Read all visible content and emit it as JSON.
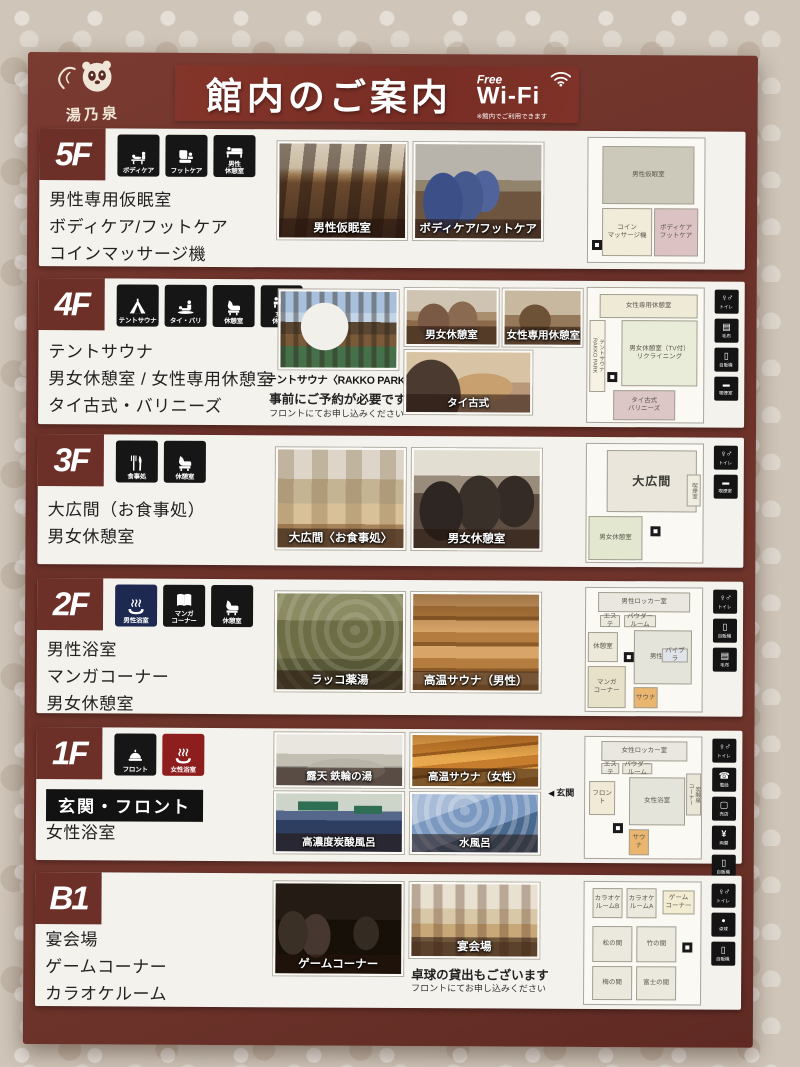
{
  "header": {
    "logo_text": "湯乃泉",
    "title": "館内のご案内",
    "wifi": {
      "free": "Free",
      "name": "Wi-Fi",
      "note": "※館内でご利用できます"
    }
  },
  "floors": [
    {
      "badge": "5F",
      "icons": [
        {
          "label": "ボディケア"
        },
        {
          "label": "フットケア"
        },
        {
          "label": "男性\n休憩室"
        }
      ],
      "facilities": [
        "男性専用仮眠室",
        "ボディケア/フットケア",
        "コインマッサージ機"
      ],
      "photos": [
        {
          "caption": "男性仮眠室"
        },
        {
          "caption": "ボディケア/フットケア"
        }
      ],
      "map": {
        "rooms": [
          "男性仮眠室",
          "コイン\nマッサージ機",
          "ボディケア\nフットケア"
        ],
        "side": []
      }
    },
    {
      "badge": "4F",
      "icons": [
        {
          "label": "テントサウナ"
        },
        {
          "label": "タイ・バリ"
        },
        {
          "label": "休憩室"
        },
        {
          "label": "女性\n休憩室"
        }
      ],
      "facilities": [
        "テントサウナ",
        "男女休憩室 / 女性専用休憩室",
        "タイ古式・バリニーズ"
      ],
      "photos": [
        {
          "caption": "テントサウナ〈RAKKO PARK〉"
        },
        {
          "caption": "男女休憩室"
        },
        {
          "caption": "女性専用休憩室"
        },
        {
          "caption": "タイ古式"
        }
      ],
      "notes": [
        "事前にご予約が必要です",
        "フロントにてお申し込みください"
      ],
      "map": {
        "rooms": [
          "女性専用休憩室",
          "男女休憩室（TV付）\nリクライニング",
          "テントサウナ\nRAKKO PARK",
          "タイ古式\nバリニーズ"
        ],
        "side": [
          "トイレ",
          "毛布",
          "自販機",
          "喫煙室"
        ]
      }
    },
    {
      "badge": "3F",
      "icons": [
        {
          "label": "食事処"
        },
        {
          "label": "休憩室"
        }
      ],
      "facilities": [
        "大広間（お食事処）",
        "男女休憩室"
      ],
      "photos": [
        {
          "caption": "大広間〈お食事処〉"
        },
        {
          "caption": "男女休憩室"
        }
      ],
      "map": {
        "rooms": [
          "大広間",
          "男女休憩室",
          "喫煙室"
        ],
        "side": [
          "トイレ",
          "喫煙室"
        ]
      }
    },
    {
      "badge": "2F",
      "icons": [
        {
          "label": "男性浴室"
        },
        {
          "label": "マンガ\nコーナー"
        },
        {
          "label": "休憩室"
        }
      ],
      "facilities": [
        "男性浴室",
        "マンガコーナー",
        "男女休憩室"
      ],
      "photos": [
        {
          "caption": "ラッコ薬湯"
        },
        {
          "caption": "高温サウナ（男性）"
        }
      ],
      "map": {
        "rooms": [
          "男性ロッカー室",
          "エステ",
          "パウダールーム",
          "休憩室",
          "男性浴室",
          "マンガ\nコーナー",
          "サウナ",
          "バイブラ"
        ],
        "side": [
          "トイレ",
          "自販機",
          "毛布"
        ]
      }
    },
    {
      "badge": "1F",
      "icons": [
        {
          "label": "フロント"
        },
        {
          "label": "女性浴室"
        }
      ],
      "boxed_facility": "玄関・フロント",
      "facilities": [
        "女性浴室"
      ],
      "photos": [
        {
          "caption": "露天 鉄輪の湯"
        },
        {
          "caption": "高温サウナ（女性）"
        },
        {
          "caption": "高濃度炭酸風呂"
        },
        {
          "caption": "水風呂"
        }
      ],
      "map": {
        "entrance": "玄関",
        "rooms": [
          "女性ロッカー室",
          "エステ",
          "パウダールーム",
          "女性浴室",
          "炭酸泉\nコーナー",
          "サウナ",
          "フロント"
        ],
        "side": [
          "トイレ",
          "電話",
          "売店",
          "両替",
          "自販機"
        ]
      }
    },
    {
      "badge": "B1",
      "icons": [],
      "facilities": [
        "宴会場",
        "ゲームコーナー",
        "カラオケルーム"
      ],
      "photos": [
        {
          "caption": "ゲームコーナー"
        },
        {
          "caption": "宴会場"
        }
      ],
      "notes": [
        "卓球の貸出もございます",
        "フロントにてお申し込みください"
      ],
      "map": {
        "rooms": [
          "カラオケ\nルームB",
          "カラオケ\nルームA",
          "ゲーム\nコーナー",
          "松の間",
          "竹の間",
          "梅の間",
          "富士の間"
        ],
        "side": [
          "トイレ",
          "卓球",
          "自販機"
        ]
      }
    }
  ]
}
